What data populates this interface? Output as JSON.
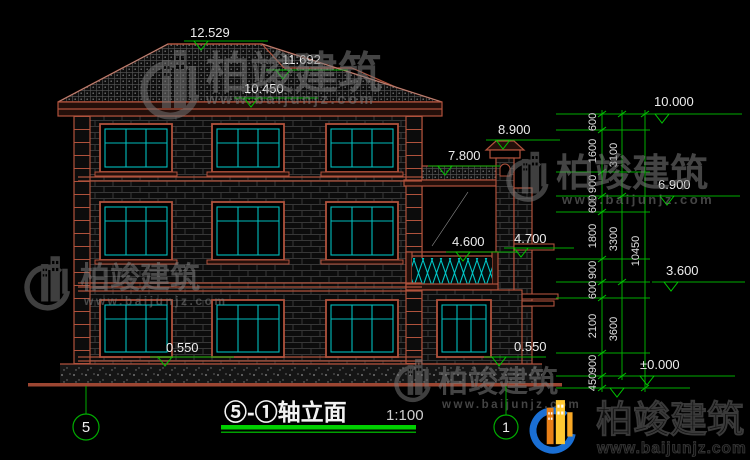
{
  "drawing_title": {
    "label": "⑤-①轴立面",
    "scale": "1:100"
  },
  "axes": {
    "left": "5",
    "right": "1"
  },
  "elevation_markers": {
    "ridge": "12.529",
    "upper_ridge": "11.692",
    "eave": "10.450",
    "chimney": "8.900",
    "wing_eave": "7.800",
    "balcony": "4.600",
    "balcony_ledge": "4.700",
    "sill_left": "0.550",
    "sill_right": "0.550",
    "parapet_top": "10.000",
    "floor3": "6.900",
    "floor2": "3.600",
    "ground": "±0.000"
  },
  "dimension_chain": {
    "segments": [
      "600",
      "1600",
      "900",
      "600",
      "1800",
      "900",
      "600",
      "2100",
      "900",
      "450"
    ],
    "spans": [
      "3100",
      "3300",
      "3600"
    ],
    "total": "10450"
  },
  "watermark": {
    "brand": "柏竣建筑",
    "url": "www.baijunjz.com"
  },
  "logo": {
    "brand": "柏竣建筑",
    "url": "www.baijunjz.com"
  }
}
